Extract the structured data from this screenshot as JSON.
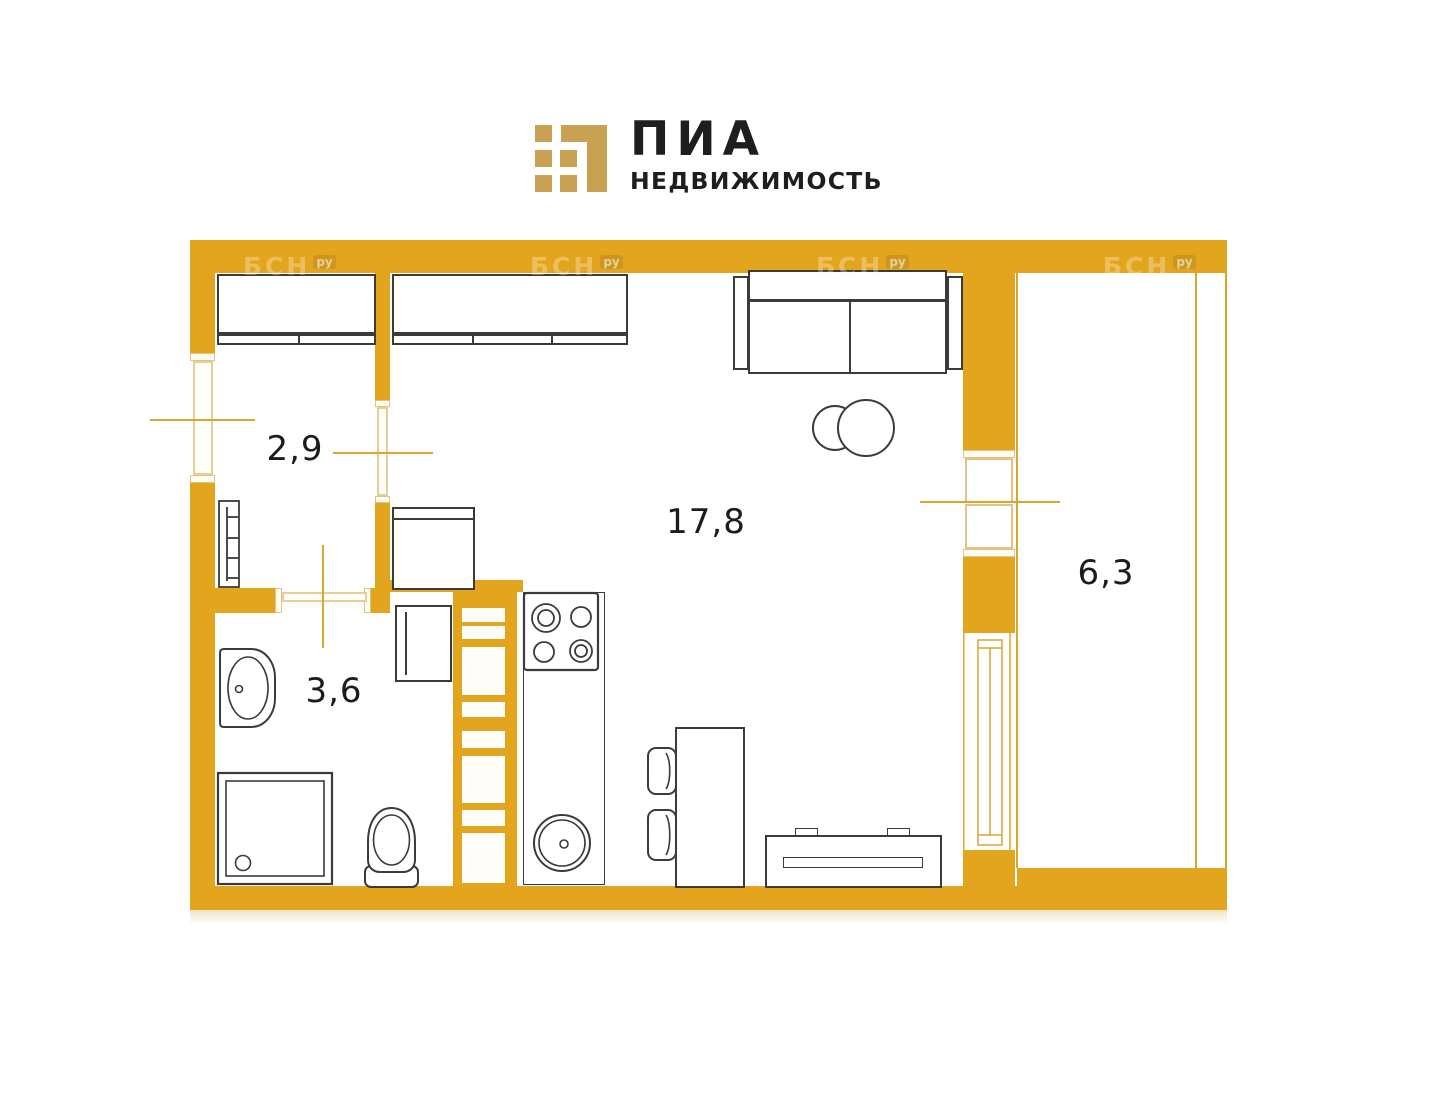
{
  "logo": {
    "title": "ПИА",
    "subtitle": "НЕДВИЖИМОСТЬ",
    "mark_color": "#C9A153"
  },
  "watermark": {
    "text": "БСН",
    "suffix": "ру"
  },
  "rooms": {
    "hallway": {
      "area": "2,9"
    },
    "bathroom": {
      "area": "3,6"
    },
    "living": {
      "area": "17,8"
    },
    "balcony": {
      "area": "6,3"
    }
  },
  "furniture": [
    "sliding-wardrobe-hallway",
    "sliding-wardrobe-living",
    "entry-radiator",
    "washbasin",
    "shower-cabin",
    "toilet",
    "washing-machine",
    "fridge",
    "kitchen-counter",
    "stove-4-burner",
    "kitchen-sink",
    "ventilation-shaft",
    "dining-table",
    "chair",
    "chair",
    "sofa",
    "coffee-table",
    "tv-stand",
    "balcony-window",
    "balcony-door-block",
    "entrance-door"
  ],
  "colors": {
    "wall": "#E3A51D",
    "accent_line": "#D9A62E",
    "opening_trim": "#E6CE96",
    "logo_gold": "#C9A153",
    "ink": "#1E1E1E",
    "furniture_stroke": "#3B3B3B"
  }
}
